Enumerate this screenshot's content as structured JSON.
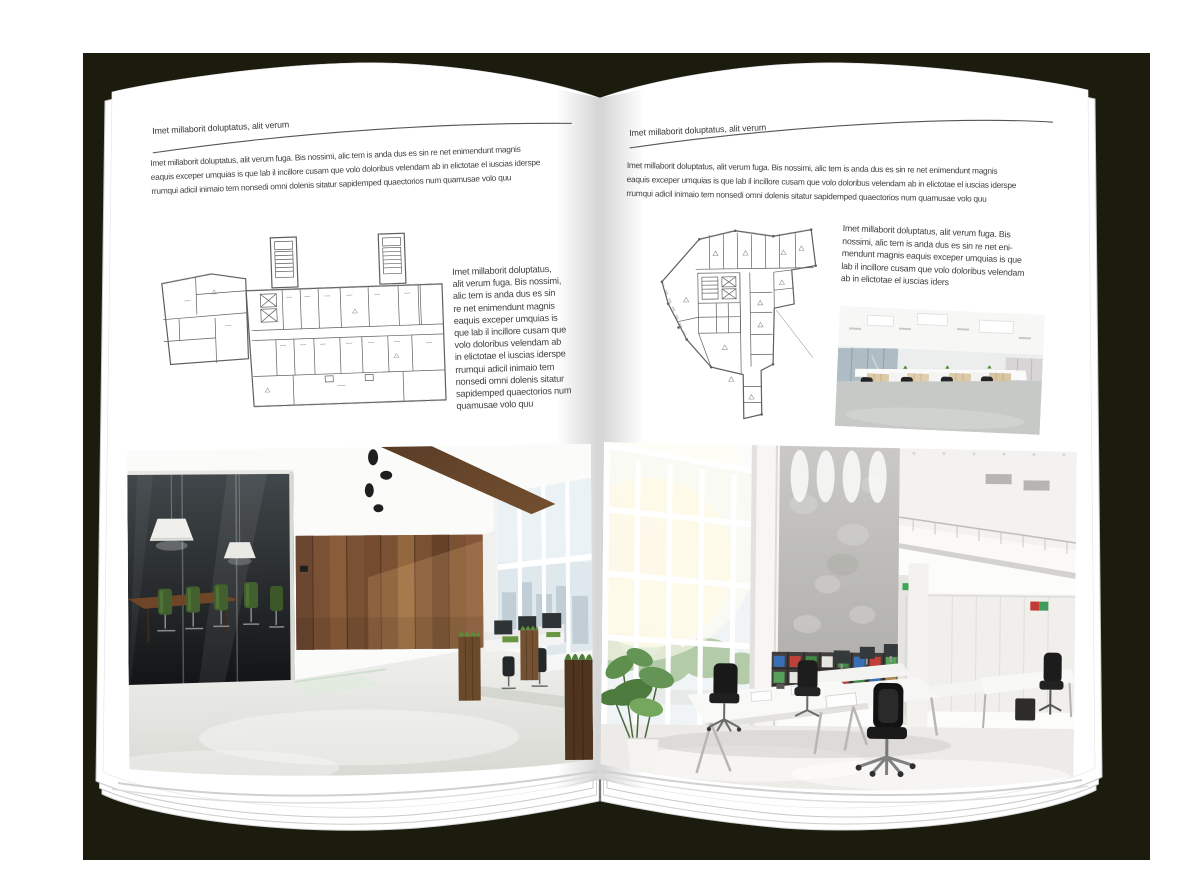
{
  "appearance": {
    "backdrop_color": "#1b1c0e",
    "page_color": "#ffffff",
    "text_color": "#3f3f3f",
    "rule_color": "#555555"
  },
  "left_page": {
    "header": "Imet millaborit doluptatus, alit verum",
    "intro": "Imet millaborit doluptatus, alit verum fuga. Bis nossimi, alic tem is anda dus es sin re net enimendunt magnis\neaquis exceper umquias is que lab il incillore cusam que volo doloribus velendam ab in elictotae el iuscias iderspe\nrrumqui adicil inimaio tem nonsedi omni dolenis sitatur sapidemped quaectorios num quamusae volo quu",
    "side_text": "Imet millaborit doluptatus,\nalit verum fuga. Bis nossimi,\nalic tem is anda dus es sin\nre net enimendunt magnis\neaquis exceper umquias is\nque lab il incillore cusam que\nvolo doloribus velendam ab\nin elictotae el iuscias iderspe\nrrumqui adicil inimaio tem\nnonsedi omni dolenis sitatur\nsapidemped quaectorios num\nquamusae volo quu"
  },
  "right_page": {
    "header": "Imet millaborit doluptatus, alit verum",
    "intro": "Imet millaborit doluptatus, alit verum fuga. Bis nossimi, alic tem is anda dus es sin re net enimendunt magnis\neaquis exceper umquias is que lab il incillore cusam que volo doloribus velendam ab in elictotae el iuscias iderspe\nrrumqui adicil inimaio tem nonsedi omni dolenis sitatur sapidemped quaectorios num quamusae volo quu",
    "side_text": "Imet millaborit doluptatus, alit verum fuga. Bis\nnossimi, alic tem is anda dus es sin re net eni-\nmendunt magnis eaquis exceper umquias is que\nlab il incillore cusam que volo doloribus velendam\nab in elictotae el iuscias iders"
  }
}
